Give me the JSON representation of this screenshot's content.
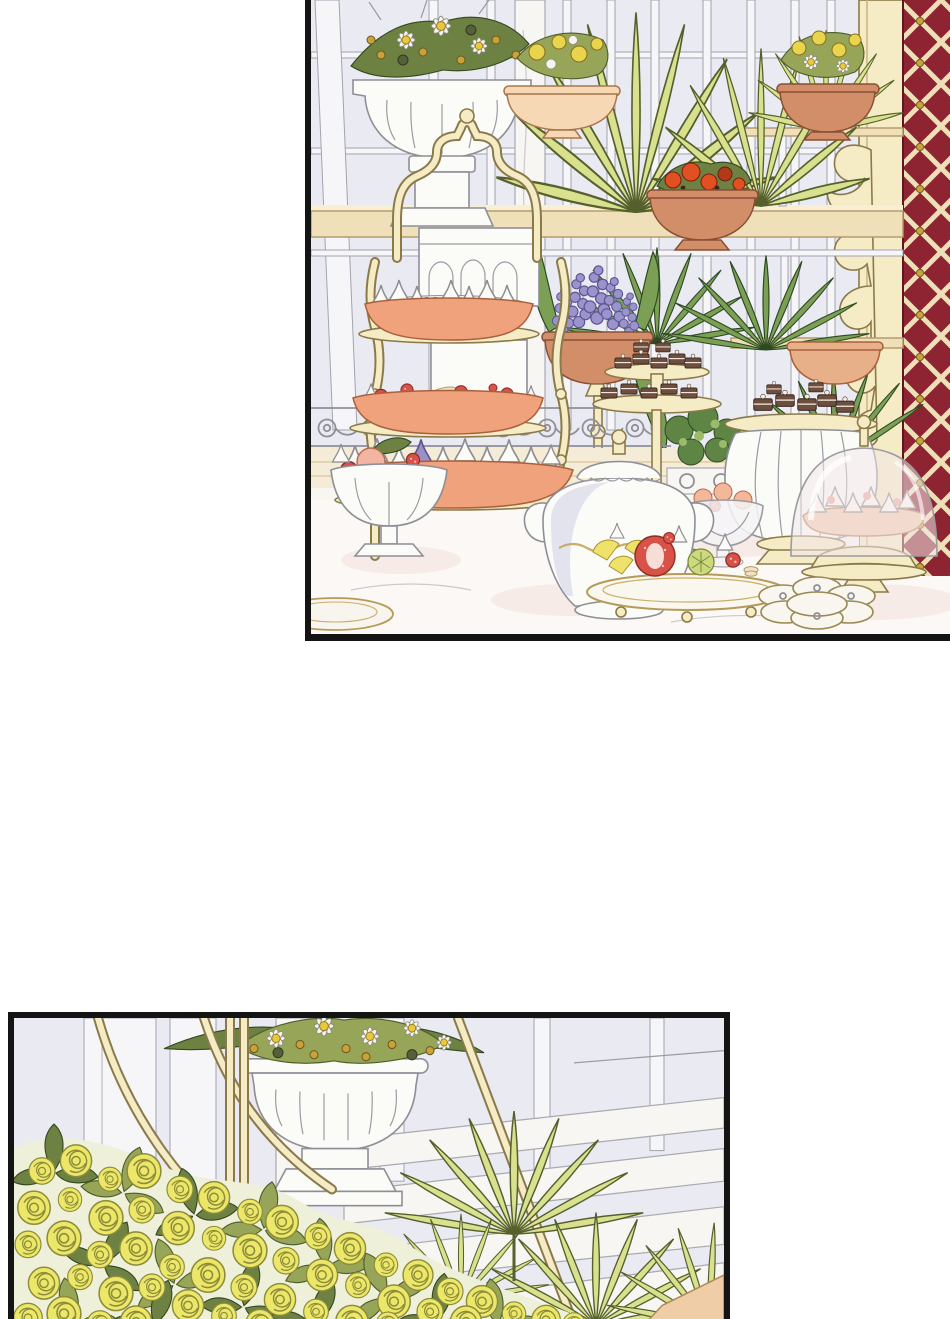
{
  "page": {
    "width": 950,
    "height": 1319,
    "media_type": "webtoon comic page, textless illustration",
    "gutter": "white space between panels",
    "text_content": "none"
  },
  "panels": [
    {
      "id": "panel-top",
      "placement": "upper right, bleeds off top and right edges, black left and bottom borders",
      "scene": "conservatory afternoon-tea table with plant shelves",
      "items": [
        "white fluted urn with daisies and golden blooms on pedestal",
        "cream bowl of yellow flowers",
        "terracotta bowl of red-orange flowers on shelf",
        "terracotta bowl of daffodils on upper rail",
        "peach bowl on right shelf",
        "purple hyacinths in terracotta pot on gold baluster",
        "light and dark fan-palm fronds",
        "brass tiered dessert cart with ogee arch handle",
        "trays of white meringue cones on peach boats",
        "tray of macarons and strawberries",
        "two-tier stand of chocolate petit fours",
        "ribbed white stand topped with chocolates",
        "white teapot with gold trim",
        "footed bowl of strawberries and peach fruit",
        "platter of strawberry tarts and lemon wedges",
        "glass pedestal bowl of peach macarons",
        "glass cloche over meringue cake",
        "scalloped flower dish",
        "green topiary in scrolled grey planter",
        "maroon wall with cream diamond lattice",
        "cream greenhouse pillar with acanthus scrolls",
        "white marble table with pink veining"
      ]
    },
    {
      "id": "panel-bottom",
      "placement": "lower left, bleeds off bottom edge, black top/left/right borders",
      "scene": "garden terrace close-up",
      "items": [
        "white fluted urn of daisies on pedestal",
        "cream hanging-basket straps and arcs",
        "dense mass of yellow roses with olive leaves",
        "fan-palm fronds",
        "white marble pillars and descending steps",
        "tan stone wedge in lower right corner"
      ]
    }
  ],
  "palette": {
    "page_bg": "#ffffff",
    "panel_border": "#141414",
    "conservatory_bg": "#e9eaf2",
    "mullion_white": "#f6f6f9",
    "mullion_stroke": "#a3a3ae",
    "marble_white": "#f8f6f3",
    "shelf_cream": "#f0e0ba",
    "shelf_edge": "#b59c6d",
    "frame_cream": "#f5ebc4",
    "frame_outline": "#8a7a4a",
    "maroon_wall": "#8e2431",
    "lattice_cream": "#ede0b8",
    "palm_light": "#d9e18f",
    "palm_dark": "#7ba055",
    "terracotta": "#d28e68",
    "peach_tray": "#efa27b",
    "meringue_white": "#fcfbf7",
    "strawberry_red": "#d95248",
    "macaron_cream": "#f2e2c4",
    "chocolate_brown": "#6e4f3f",
    "hyacinth_purple": "#9a93cc",
    "daisy_white": "#f6f4ee",
    "daisy_yellow": "#e8c83f",
    "gold_flower": "#c9a23a",
    "rose_yellow": "#ece768",
    "rose_outline": "#8c8c3a",
    "rose_leaf": "#97a558",
    "rose_leaf_dark": "#6d8142",
    "urn_white": "#fbfbf8",
    "urn_stroke": "#8e8e96",
    "glass_tint": "#f3e7e9",
    "table_pink": "#f3e3de",
    "tan_stone": "#efcda6"
  }
}
